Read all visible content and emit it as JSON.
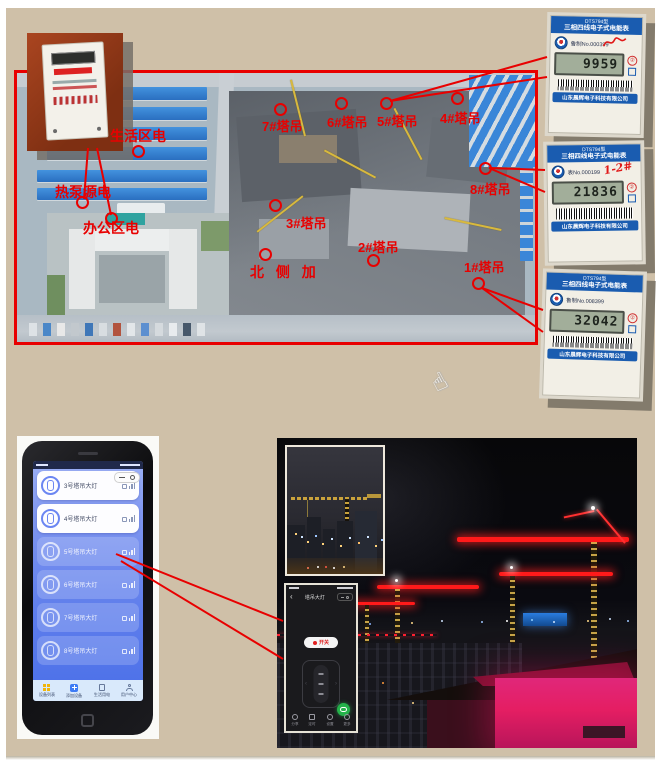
{
  "colors": {
    "annotation_red": "#e80000",
    "slide_background": "#cfc0a8",
    "meter_header_blue": "#1a5cb0",
    "app_blue": "#5f7eec",
    "crane_light_red": "#ff1a1a",
    "night_pink": "#e51e63"
  },
  "site_map": {
    "area_labels": [
      {
        "text": "生活区电"
      },
      {
        "text": "热泵源电"
      },
      {
        "text": "办公区电"
      },
      {
        "text": "北 侧 加"
      }
    ],
    "crane_labels": [
      {
        "text": "7#塔吊"
      },
      {
        "text": "6#塔吊"
      },
      {
        "text": "5#塔吊"
      },
      {
        "text": "4#塔吊"
      },
      {
        "text": "8#塔吊"
      },
      {
        "text": "3#塔吊"
      },
      {
        "text": "2#塔吊"
      },
      {
        "text": "1#塔吊"
      }
    ]
  },
  "meters": {
    "header_model": "DTS794型",
    "header_type": "三相四线电子式电能表",
    "company": "山东晨辉电子科技有限公司",
    "seal": "②",
    "items": [
      {
        "serial": "鲁制No.000399",
        "reading": "9959",
        "handwriting": ""
      },
      {
        "serial": "表No.000199",
        "reading": "21836",
        "handwriting": "1-2#"
      },
      {
        "serial": "鲁制No.008399",
        "reading": "32042",
        "handwriting": ""
      }
    ]
  },
  "phone_app": {
    "cards": [
      {
        "label": "3号塔吊大灯"
      },
      {
        "label": "4号塔吊大灯"
      },
      {
        "label": "5号塔吊大灯"
      },
      {
        "label": "6号塔吊大灯"
      },
      {
        "label": "7号塔吊大灯"
      },
      {
        "label": "8号塔吊大灯"
      }
    ],
    "nav": [
      {
        "label": "设备列表"
      },
      {
        "label": "添加设备"
      },
      {
        "label": "生活用电"
      },
      {
        "label": "用户中心"
      }
    ]
  },
  "control_screen": {
    "back": "‹",
    "title": "塔吊大灯",
    "power_label": "开关",
    "actions": [
      {
        "label": "分享"
      },
      {
        "label": "定时"
      },
      {
        "label": "设置"
      },
      {
        "label": "更多"
      }
    ]
  },
  "cursor_glyph": "☝"
}
